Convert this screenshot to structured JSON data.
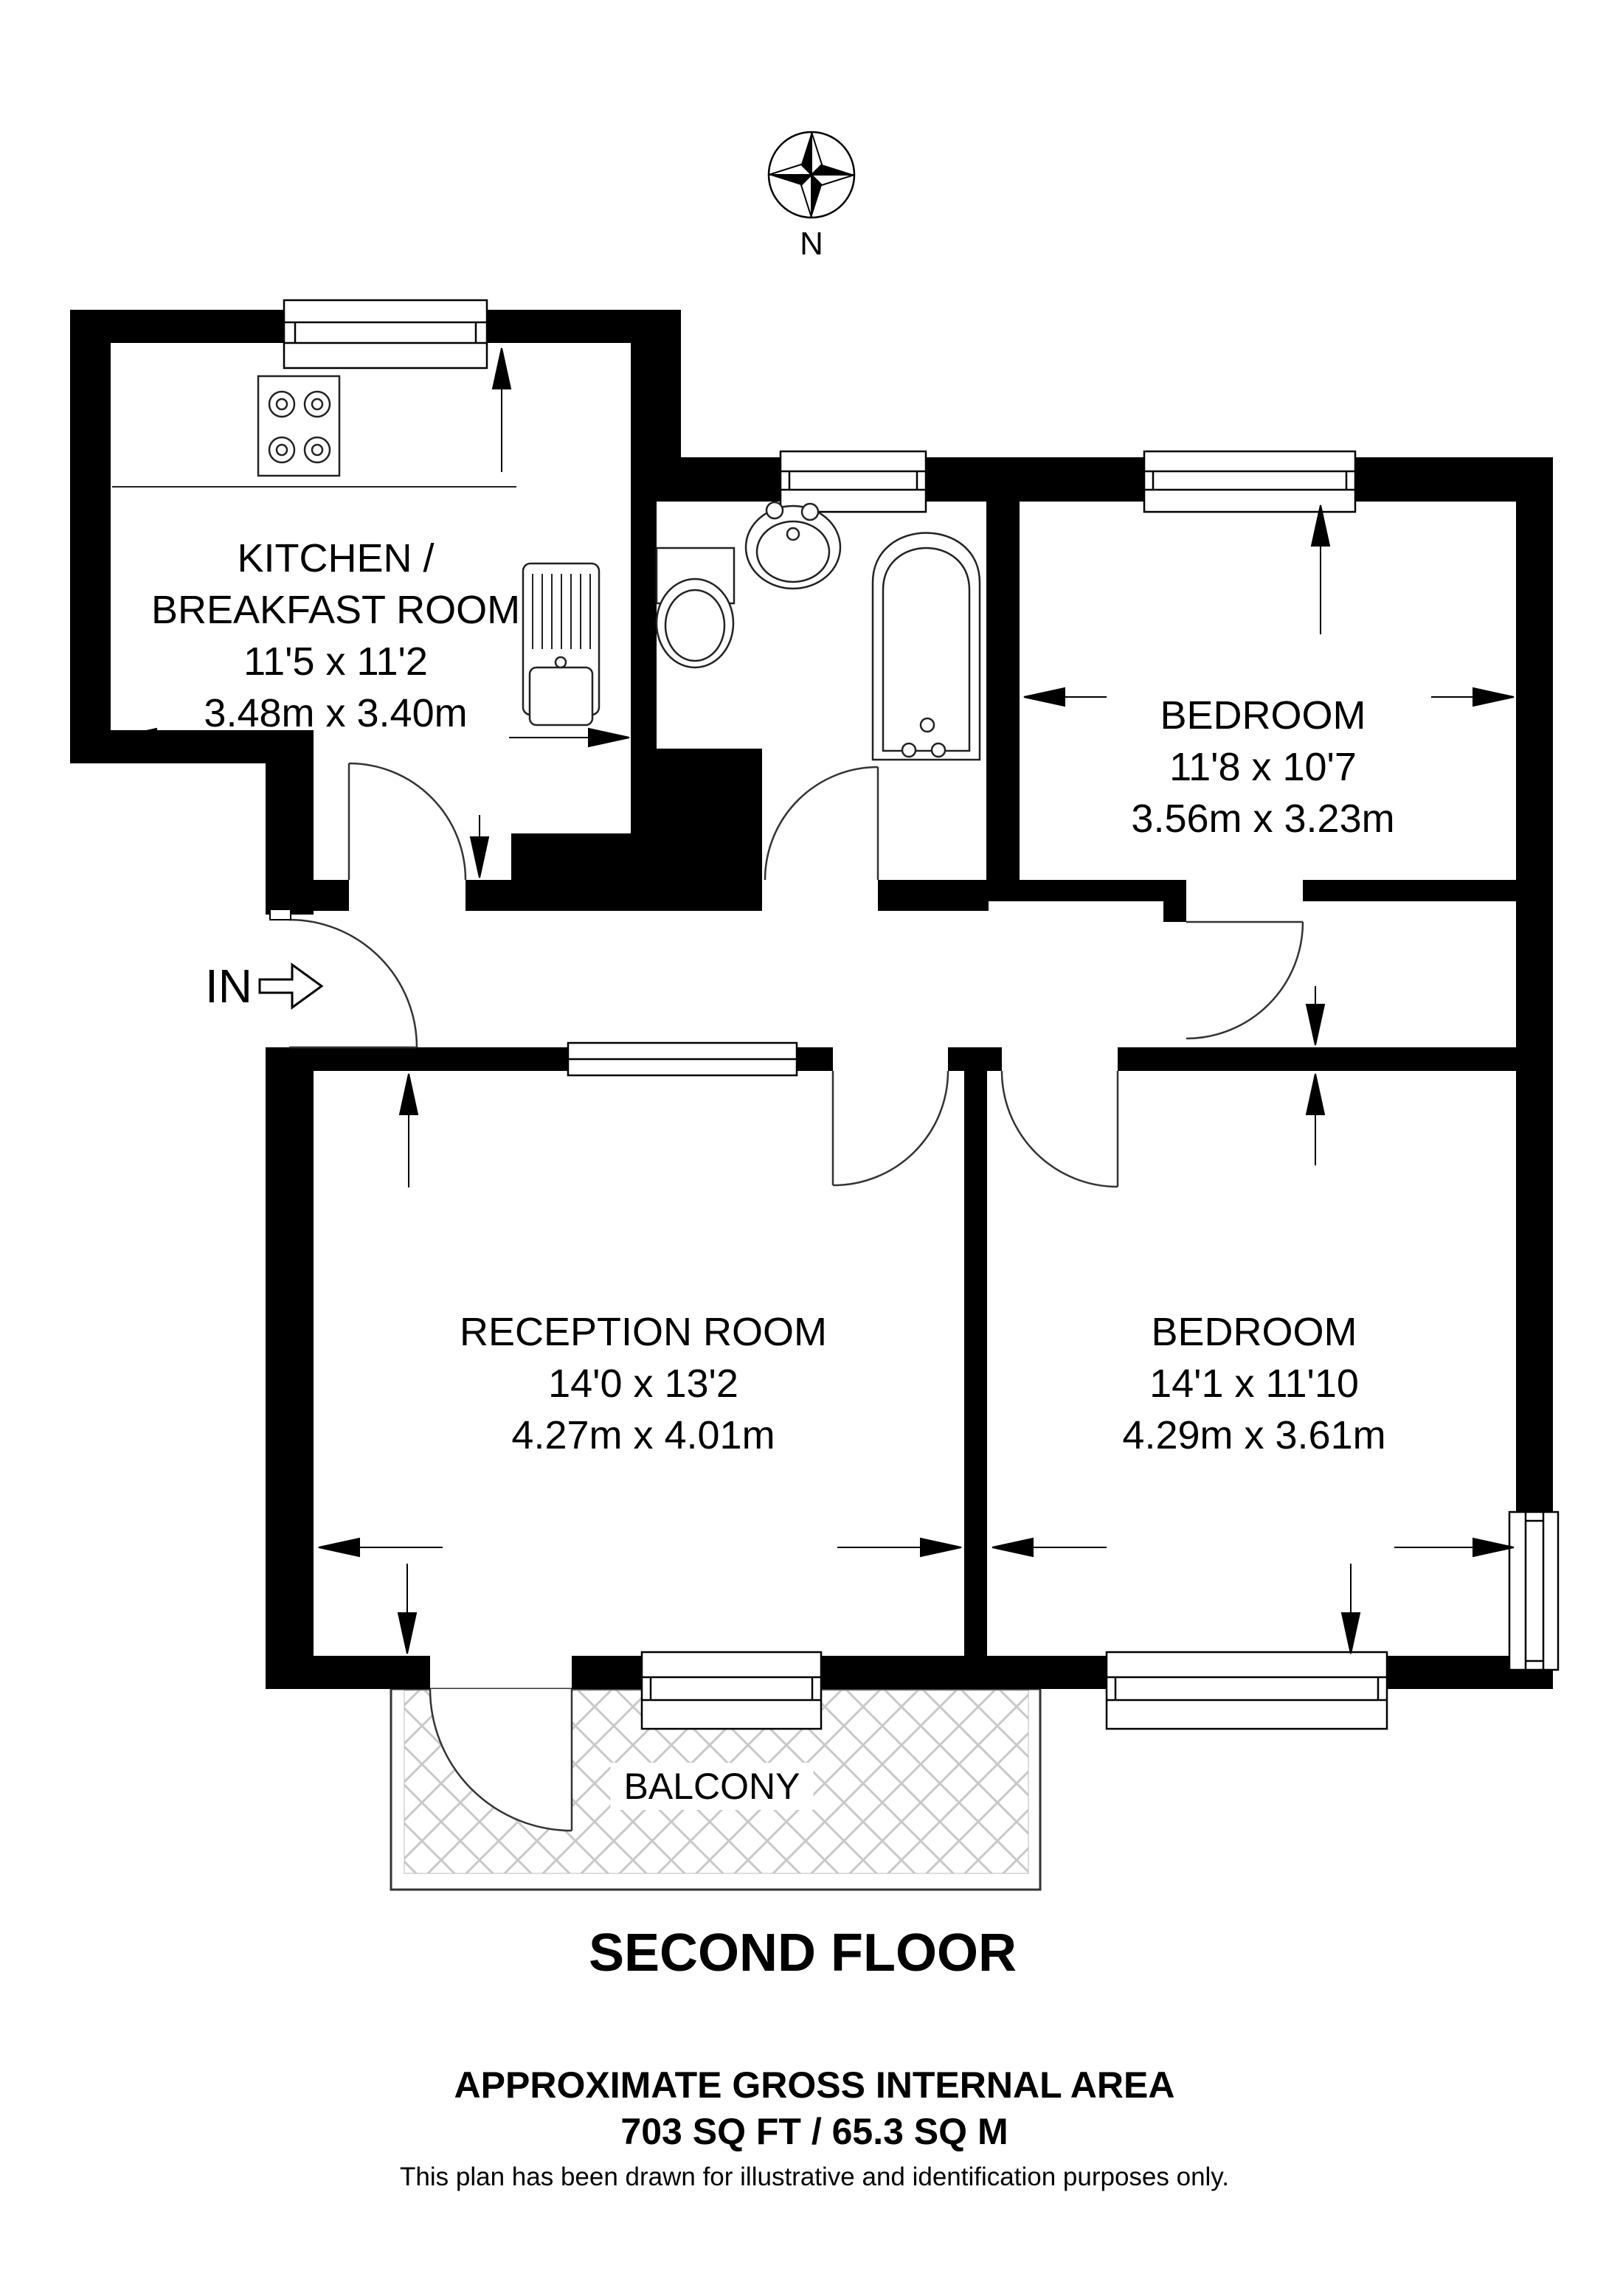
{
  "compass": {
    "label": "N"
  },
  "entrance": {
    "label": "IN"
  },
  "rooms": {
    "kitchen": {
      "name_line1": "KITCHEN /",
      "name_line2": "BREAKFAST ROOM",
      "imperial": "11'5 x 11'2",
      "metric": "3.48m x 3.40m"
    },
    "bedroom1": {
      "name": "BEDROOM",
      "imperial": "11'8 x 10'7",
      "metric": "3.56m x 3.23m"
    },
    "reception": {
      "name": "RECEPTION ROOM",
      "imperial": "14'0 x 13'2",
      "metric": "4.27m x 4.01m"
    },
    "bedroom2": {
      "name": "BEDROOM",
      "imperial": "14'1 x 11'10",
      "metric": "4.29m x 3.61m"
    },
    "balcony": {
      "name": "BALCONY"
    }
  },
  "footer": {
    "floor_title": "SECOND FLOOR",
    "area_heading": "APPROXIMATE GROSS INTERNAL AREA",
    "area_value": "703 SQ FT / 65.3 SQ M",
    "disclaimer": "This plan has been drawn for illustrative and identification purposes only."
  },
  "colors": {
    "wall": "#000000",
    "hatch": "#c9c9c9",
    "background": "#ffffff"
  }
}
